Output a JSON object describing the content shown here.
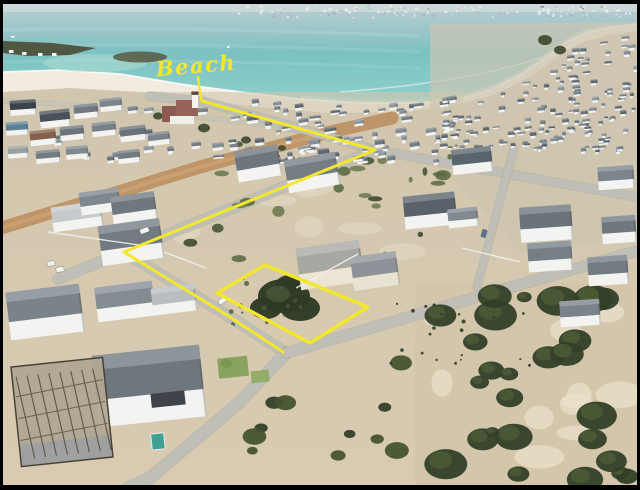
{
  "photo": {
    "kind": "aerial-drone-photo",
    "description": "Aerial view of a white-walled coastal village on a curving turquoise bay; a vacant plot is outlined in yellow and a yellow route line leads along the streets to the beach access.",
    "border_color": "#000000"
  },
  "annotations": {
    "beach_label": "Beach",
    "color": "#f3e72e",
    "leader_path": "M198,77 C199,85 200,94 202,101",
    "route_points": "202,101 375,150 124,252 230,317 283,352",
    "plot_outline_points": "217,293 265,265 368,307 310,343"
  },
  "palette": {
    "sea_deep": "#b2cbd0",
    "sea_mid": "#7cc1c2",
    "sea_shallow": "#8ed0cc",
    "surf": "#ffffff",
    "beach_sand": "#f1ecdf",
    "ground_sand": "#d5c8b0",
    "dune_sand": "#d3c6ab",
    "road_gray": "#bfbfb7",
    "dirt_road": "#bd9264",
    "roof_gray": "#727b82",
    "wall_white": "#f3f4f1",
    "bush_green": "#3d4a2e",
    "horizon_haze": "#cbd8da"
  }
}
